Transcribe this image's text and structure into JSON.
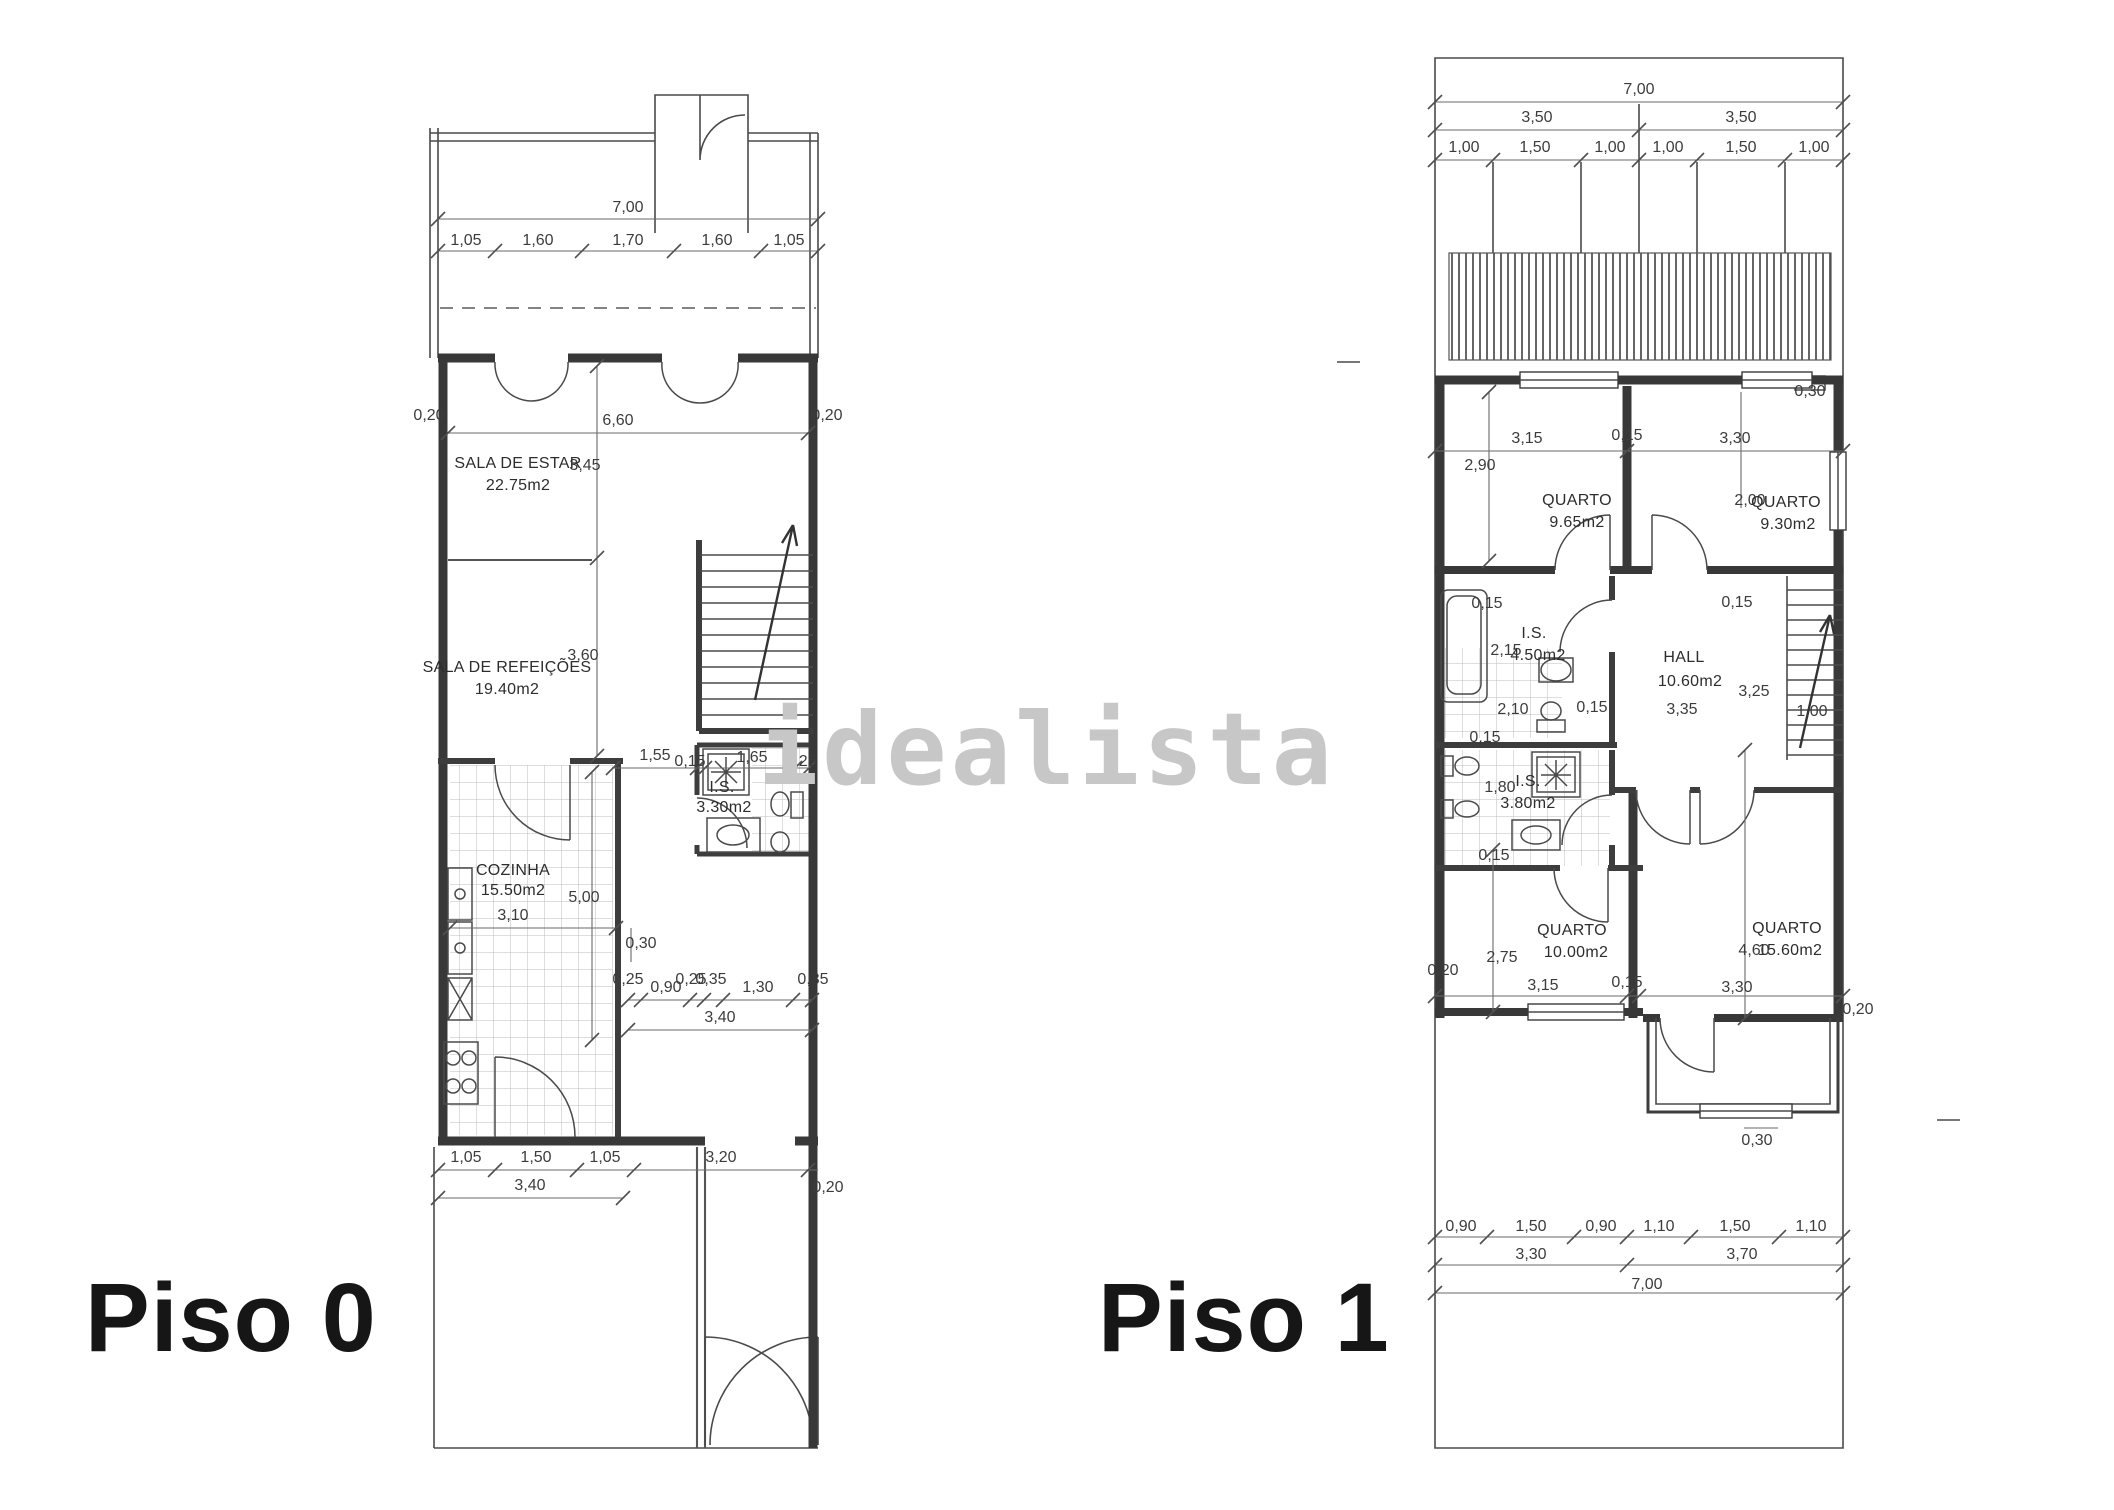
{
  "watermark": "idealista",
  "plans": {
    "piso0": {
      "label": "Piso 0",
      "annotations": [
        {
          "t": "7,00",
          "x": 628,
          "y": 212
        },
        {
          "t": "1,05",
          "x": 466,
          "y": 245
        },
        {
          "t": "1,60",
          "x": 538,
          "y": 245
        },
        {
          "t": "1,70",
          "x": 628,
          "y": 245
        },
        {
          "t": "1,60",
          "x": 717,
          "y": 245
        },
        {
          "t": "1,05",
          "x": 789,
          "y": 245
        },
        {
          "t": "0,20",
          "x": 429,
          "y": 420,
          "r": -90
        },
        {
          "t": "6,60",
          "x": 618,
          "y": 425
        },
        {
          "t": "0,20",
          "x": 827,
          "y": 420,
          "r": -90
        },
        {
          "t": "3,45",
          "x": 585,
          "y": 470,
          "r": -90
        },
        {
          "t": "SALA DE ESTAR",
          "x": 518,
          "y": 468,
          "c": "room"
        },
        {
          "t": "22.75m2",
          "x": 518,
          "y": 490,
          "c": "room"
        },
        {
          "t": "SALA DE REFEIÇÕES",
          "x": 507,
          "y": 672,
          "c": "room"
        },
        {
          "t": "19.40m2",
          "x": 507,
          "y": 694,
          "c": "room"
        },
        {
          "t": "3,60",
          "x": 583,
          "y": 660,
          "r": -90
        },
        {
          "t": "1,55",
          "x": 655,
          "y": 760
        },
        {
          "t": "0,15",
          "x": 690,
          "y": 766,
          "r": -90
        },
        {
          "t": "1,65",
          "x": 752,
          "y": 762
        },
        {
          "t": "0,25",
          "x": 801,
          "y": 766,
          "r": -90
        },
        {
          "t": "I.S.",
          "x": 722,
          "y": 792,
          "c": "room"
        },
        {
          "t": "3.30m2",
          "x": 724,
          "y": 812,
          "c": "room"
        },
        {
          "t": "COZINHA",
          "x": 513,
          "y": 875,
          "c": "room"
        },
        {
          "t": "15.50m2",
          "x": 513,
          "y": 895,
          "c": "room"
        },
        {
          "t": "3,10",
          "x": 513,
          "y": 920
        },
        {
          "t": "5,00",
          "x": 584,
          "y": 902,
          "r": -90
        },
        {
          "t": "0,30",
          "x": 641,
          "y": 948,
          "r": -90
        },
        {
          "t": "0,25",
          "x": 628,
          "y": 984,
          "r": -90
        },
        {
          "t": "0,90",
          "x": 666,
          "y": 992
        },
        {
          "t": "0,25",
          "x": 691,
          "y": 984,
          "r": -90
        },
        {
          "t": "0,35",
          "x": 711,
          "y": 984,
          "r": -90
        },
        {
          "t": "1,30",
          "x": 758,
          "y": 992
        },
        {
          "t": "0,35",
          "x": 813,
          "y": 984,
          "r": -90
        },
        {
          "t": "3,40",
          "x": 720,
          "y": 1022
        },
        {
          "t": "1,05",
          "x": 466,
          "y": 1162
        },
        {
          "t": "1,50",
          "x": 536,
          "y": 1162
        },
        {
          "t": "1,05",
          "x": 605,
          "y": 1162
        },
        {
          "t": "3,20",
          "x": 721,
          "y": 1162
        },
        {
          "t": "3,40",
          "x": 530,
          "y": 1190
        },
        {
          "t": "0,20",
          "x": 828,
          "y": 1192,
          "r": -90
        }
      ]
    },
    "piso1": {
      "label": "Piso 1",
      "annotations": [
        {
          "t": "7,00",
          "x": 1639,
          "y": 94
        },
        {
          "t": "3,50",
          "x": 1537,
          "y": 122
        },
        {
          "t": "3,50",
          "x": 1741,
          "y": 122
        },
        {
          "t": "1,00",
          "x": 1464,
          "y": 152
        },
        {
          "t": "1,50",
          "x": 1535,
          "y": 152
        },
        {
          "t": "1,00",
          "x": 1610,
          "y": 152
        },
        {
          "t": "1,00",
          "x": 1668,
          "y": 152
        },
        {
          "t": "1,50",
          "x": 1741,
          "y": 152
        },
        {
          "t": "1,00",
          "x": 1814,
          "y": 152
        },
        {
          "t": "0,30",
          "x": 1810,
          "y": 396
        },
        {
          "t": "3,15",
          "x": 1527,
          "y": 443
        },
        {
          "t": "0,15",
          "x": 1627,
          "y": 440,
          "r": -90
        },
        {
          "t": "3,30",
          "x": 1735,
          "y": 443
        },
        {
          "t": "2,90",
          "x": 1480,
          "y": 470,
          "r": -90
        },
        {
          "t": "QUARTO",
          "x": 1577,
          "y": 505,
          "c": "room"
        },
        {
          "t": "9.65m2",
          "x": 1577,
          "y": 527,
          "c": "room"
        },
        {
          "t": "2,00",
          "x": 1750,
          "y": 505,
          "r": -90
        },
        {
          "t": "QUARTO",
          "x": 1786,
          "y": 507,
          "c": "room"
        },
        {
          "t": "9.30m2",
          "x": 1788,
          "y": 529,
          "c": "room"
        },
        {
          "t": "0,15",
          "x": 1487,
          "y": 608
        },
        {
          "t": "0,15",
          "x": 1737,
          "y": 607
        },
        {
          "t": "I.S.",
          "x": 1534,
          "y": 638,
          "c": "room"
        },
        {
          "t": "4.50m2",
          "x": 1538,
          "y": 660,
          "c": "room"
        },
        {
          "t": "2,15",
          "x": 1506,
          "y": 655,
          "r": -90
        },
        {
          "t": "HALL",
          "x": 1684,
          "y": 662,
          "c": "room"
        },
        {
          "t": "10.60m2",
          "x": 1690,
          "y": 686,
          "c": "room"
        },
        {
          "t": "2,10",
          "x": 1513,
          "y": 714
        },
        {
          "t": "0,15",
          "x": 1592,
          "y": 712,
          "r": -90
        },
        {
          "t": "3,35",
          "x": 1682,
          "y": 714
        },
        {
          "t": "3,25",
          "x": 1754,
          "y": 696,
          "r": -90
        },
        {
          "t": "1,00",
          "x": 1812,
          "y": 716
        },
        {
          "t": "0,15",
          "x": 1485,
          "y": 742
        },
        {
          "t": "I.S.",
          "x": 1528,
          "y": 786,
          "c": "room"
        },
        {
          "t": "3.80m2",
          "x": 1528,
          "y": 808,
          "c": "room"
        },
        {
          "t": "1,80",
          "x": 1500,
          "y": 792,
          "r": -90
        },
        {
          "t": "0,15",
          "x": 1494,
          "y": 860
        },
        {
          "t": "QUARTO",
          "x": 1572,
          "y": 935,
          "c": "room"
        },
        {
          "t": "10.00m2",
          "x": 1576,
          "y": 957,
          "c": "room"
        },
        {
          "t": "2,75",
          "x": 1502,
          "y": 962,
          "r": -90
        },
        {
          "t": "3,15",
          "x": 1543,
          "y": 990
        },
        {
          "t": "0,15",
          "x": 1627,
          "y": 987,
          "r": -90
        },
        {
          "t": "QUARTO",
          "x": 1787,
          "y": 933,
          "c": "room"
        },
        {
          "t": "15.60m2",
          "x": 1790,
          "y": 955,
          "c": "room"
        },
        {
          "t": "4,60",
          "x": 1754,
          "y": 955,
          "r": -90
        },
        {
          "t": "3,30",
          "x": 1737,
          "y": 992
        },
        {
          "t": "0,20",
          "x": 1858,
          "y": 1014,
          "r": -90
        },
        {
          "t": "0,20",
          "x": 1443,
          "y": 975,
          "r": -90
        },
        {
          "t": "0,30",
          "x": 1757,
          "y": 1145
        },
        {
          "t": "0,90",
          "x": 1461,
          "y": 1231
        },
        {
          "t": "1,50",
          "x": 1531,
          "y": 1231
        },
        {
          "t": "0,90",
          "x": 1601,
          "y": 1231
        },
        {
          "t": "1,10",
          "x": 1659,
          "y": 1231
        },
        {
          "t": "1,50",
          "x": 1735,
          "y": 1231
        },
        {
          "t": "1,10",
          "x": 1811,
          "y": 1231
        },
        {
          "t": "3,30",
          "x": 1531,
          "y": 1259
        },
        {
          "t": "3,70",
          "x": 1742,
          "y": 1259
        },
        {
          "t": "7,00",
          "x": 1647,
          "y": 1289
        }
      ]
    }
  }
}
